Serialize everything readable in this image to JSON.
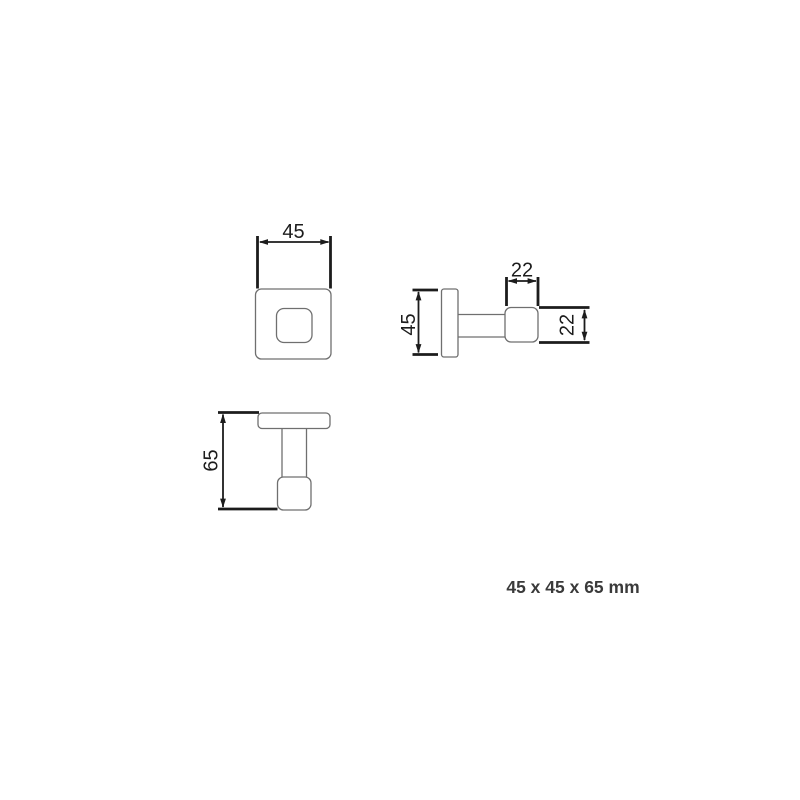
{
  "drawing": {
    "caption": "45 x 45 x 65 mm",
    "views": {
      "front": {
        "name": "front view (wall plate with hook tip)",
        "width_dim": "45"
      },
      "side": {
        "name": "side view (horizontal projection)",
        "plate_height_dim": "45",
        "hook_depth_dim": "22",
        "hook_height_dim": "22"
      },
      "profile": {
        "name": "profile view (overall projection)",
        "overall_depth_dim": "65"
      }
    },
    "units": "mm",
    "colors": {
      "background": "#ffffff",
      "object_outline": "#6f6f6f",
      "dimension": "#1c1c1c",
      "caption_text": "#3a3a3a"
    }
  }
}
